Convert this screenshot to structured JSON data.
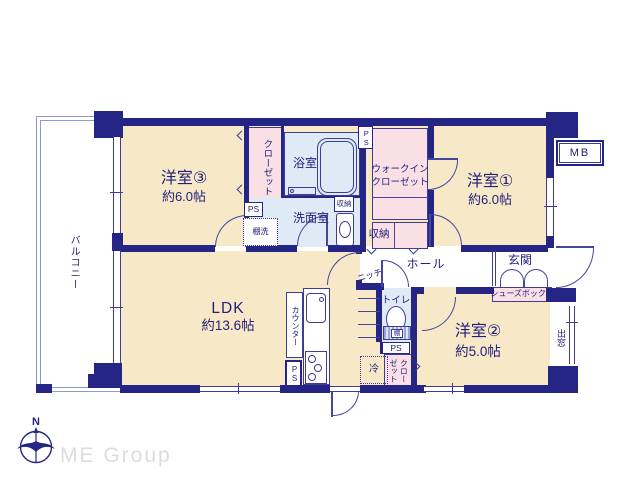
{
  "colors": {
    "wall": "#252585",
    "room_cream": "#F7E9C8",
    "closet_pink": "#FADFE5",
    "wet_blue": "#DEEAF6",
    "line": "#3D3D95",
    "logo_gray": "#DCDCDC"
  },
  "labels": {
    "balcony": "バルコニー",
    "room3": "洋室③",
    "room3_size": "約6.0帖",
    "closet": "クローゼット",
    "bath": "浴室",
    "washroom": "洗面室",
    "ps": "PS",
    "shelf_wash": "棚洗",
    "storage": "収納",
    "wic1": "ウォークイン",
    "wic2": "クローゼット",
    "room1": "洋室①",
    "room1_size": "約6.0帖",
    "mb": "MB",
    "hall": "ホール",
    "niche": "ニッチ",
    "genkan": "玄関",
    "shoebox": "シューズボックス",
    "toilet": "トイレ",
    "shelf": "棚",
    "fridge": "冷",
    "room2": "洋室②",
    "room2_size": "約5.0帖",
    "bay_window": "出窓",
    "counter": "カウンター",
    "ldk": "LDK",
    "ldk_size": "約13.6帖",
    "compass_n": "N",
    "brand": "ME Group"
  }
}
